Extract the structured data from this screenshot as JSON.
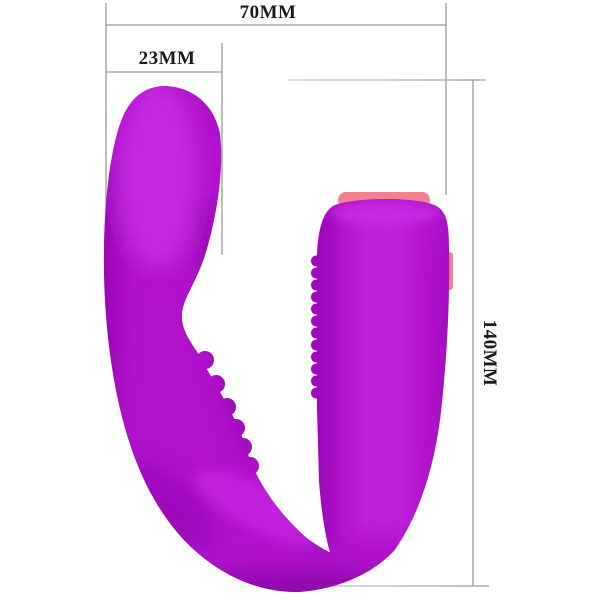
{
  "figure": {
    "kind": "product-dimension-diagram",
    "subject": "u-shaped-purple-silicone-massager",
    "background": "#ffffff"
  },
  "annotations": {
    "width": {
      "label": "70MM"
    },
    "head_width": {
      "label": "23MM"
    },
    "height": {
      "label": "140MM"
    }
  },
  "style": {
    "line_color": "#9a9a9a",
    "line_color_light": "#c9c9c9",
    "text_color": "#1b1b1b",
    "body_color": "#b112cc",
    "body_light": "#d63af2",
    "body_dark": "#8a09a8",
    "body_deep": "#740693",
    "accent_pink": "#f2808e"
  }
}
